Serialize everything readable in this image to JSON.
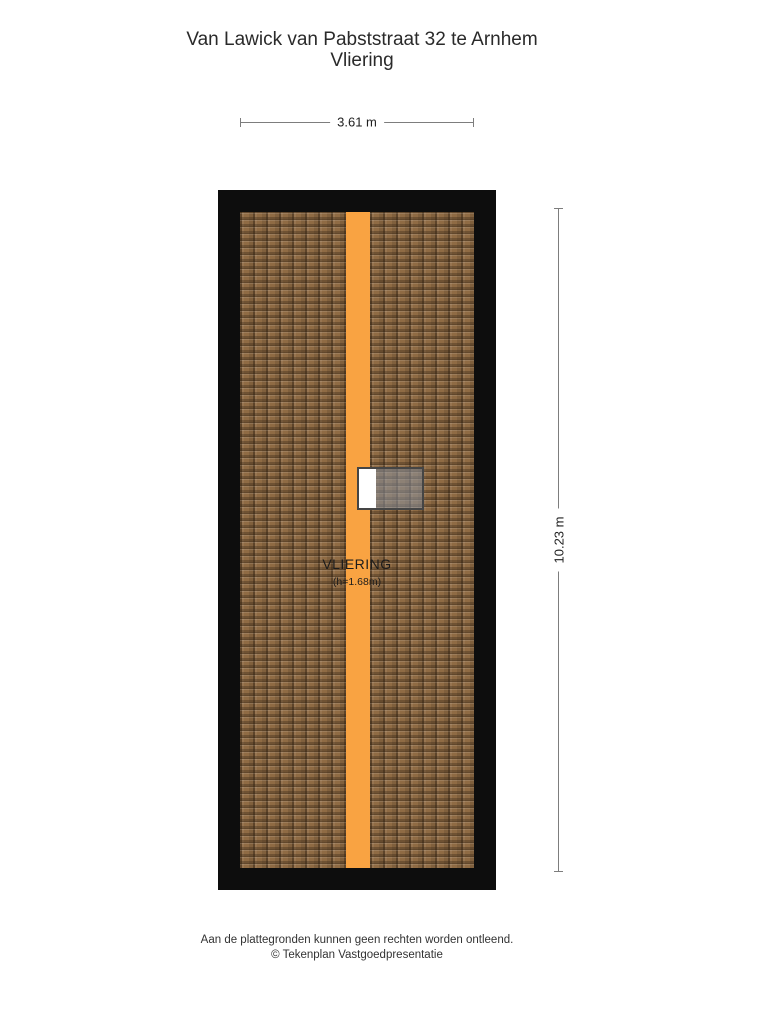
{
  "title": {
    "line1": "Van Lawick van Pabststraat 32 te Arnhem",
    "line2": "Vliering"
  },
  "dimensions": {
    "width_label": "3.61 m",
    "height_label": "10.23 m"
  },
  "room": {
    "name": "VLIERING",
    "height_note": "(h=1.68m)"
  },
  "footer": {
    "line1": "Aan de plattegronden kunnen geen rechten worden ontleend.",
    "line2": "© Tekenplan Vastgoedpresentatie"
  },
  "colors": {
    "wall_outline": "#0d0d0d",
    "roof_tile_base": "#8f6b44",
    "roof_tile_shadow": "#584026",
    "ridge_beam_orange": "#f9a342",
    "skylight_glass": "#8d939f",
    "dimension_line": "#7d7d7d",
    "text": "#2a2a2a"
  }
}
